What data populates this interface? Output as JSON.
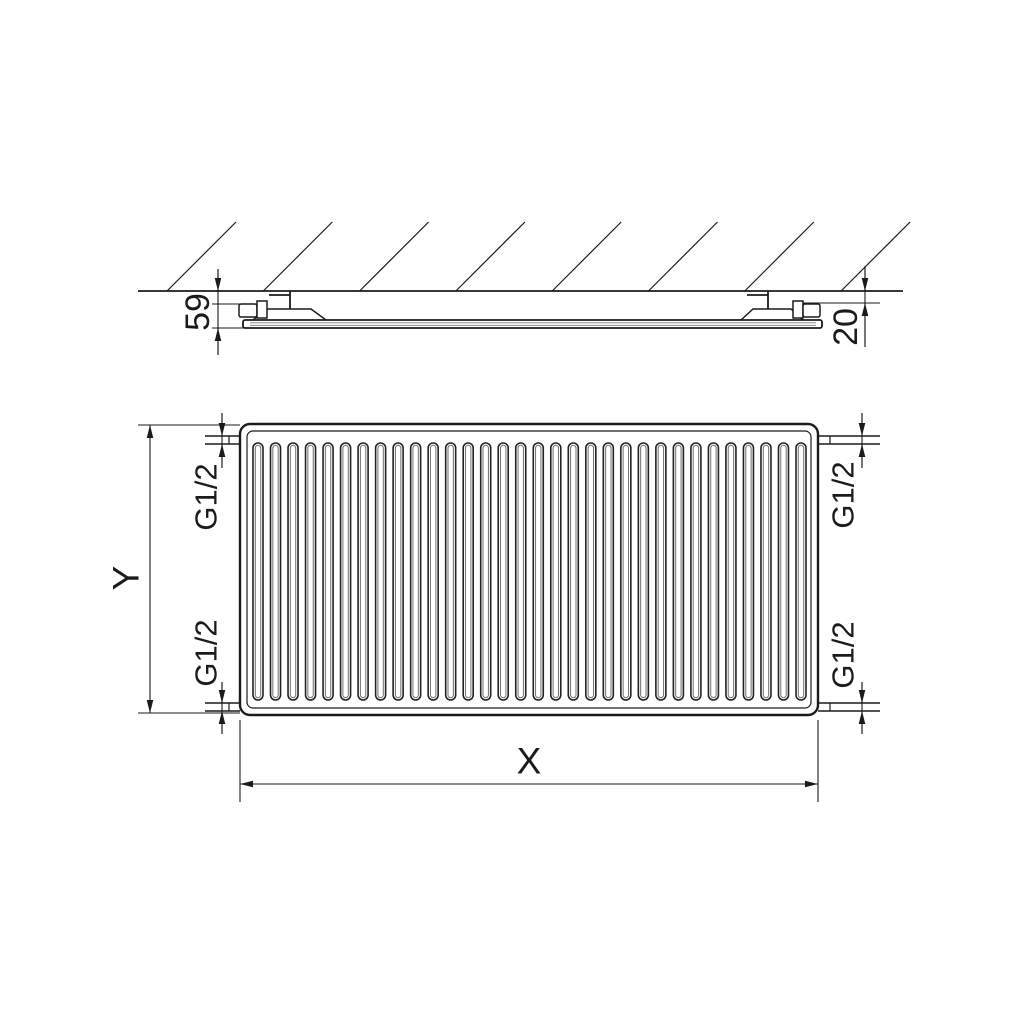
{
  "drawing": {
    "subject": "panel-radiator-dimension-drawing",
    "side_view": {
      "depth_dimension": "59",
      "wall_clearance_dimension": "20",
      "hatch_count": 8
    },
    "front_view": {
      "width_dimension": "X",
      "height_dimension": "Y",
      "channel_count": 32,
      "connections": {
        "top_left": "G1/2",
        "top_right": "G1/2",
        "bottom_left": "G1/2",
        "bottom_right": "G1/2"
      }
    },
    "colors": {
      "line": "#1b1b1b",
      "line_soft": "#8c8c8c",
      "channel_inner": "#707070",
      "background": "#ffffff"
    }
  }
}
